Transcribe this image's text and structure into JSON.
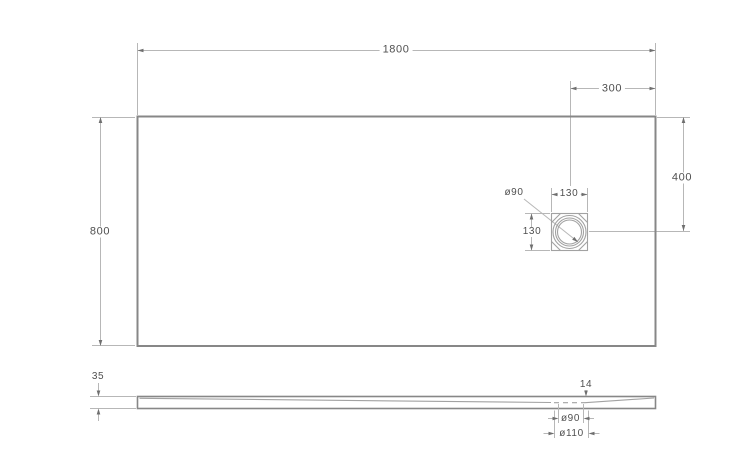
{
  "colors": {
    "background": "#ffffff",
    "object_line": "#878787",
    "dimension_line": "#b7b7b7",
    "detail_line": "#a2a2a2",
    "arrow": "#6f6f6f",
    "text": "#4f4f4f"
  },
  "drawing": {
    "top_view": {
      "width": "1800",
      "depth": "800",
      "drain_offset_horizontal": "300",
      "drain_offset_vertical": "400",
      "drain_flange_width": "130",
      "drain_flange_height": "130",
      "drain_diameter": "ø90"
    },
    "side_view": {
      "height": "35",
      "drain_drop": "14",
      "drain_hole_diameter": "ø90",
      "drain_recess_diameter": "ø110"
    }
  }
}
